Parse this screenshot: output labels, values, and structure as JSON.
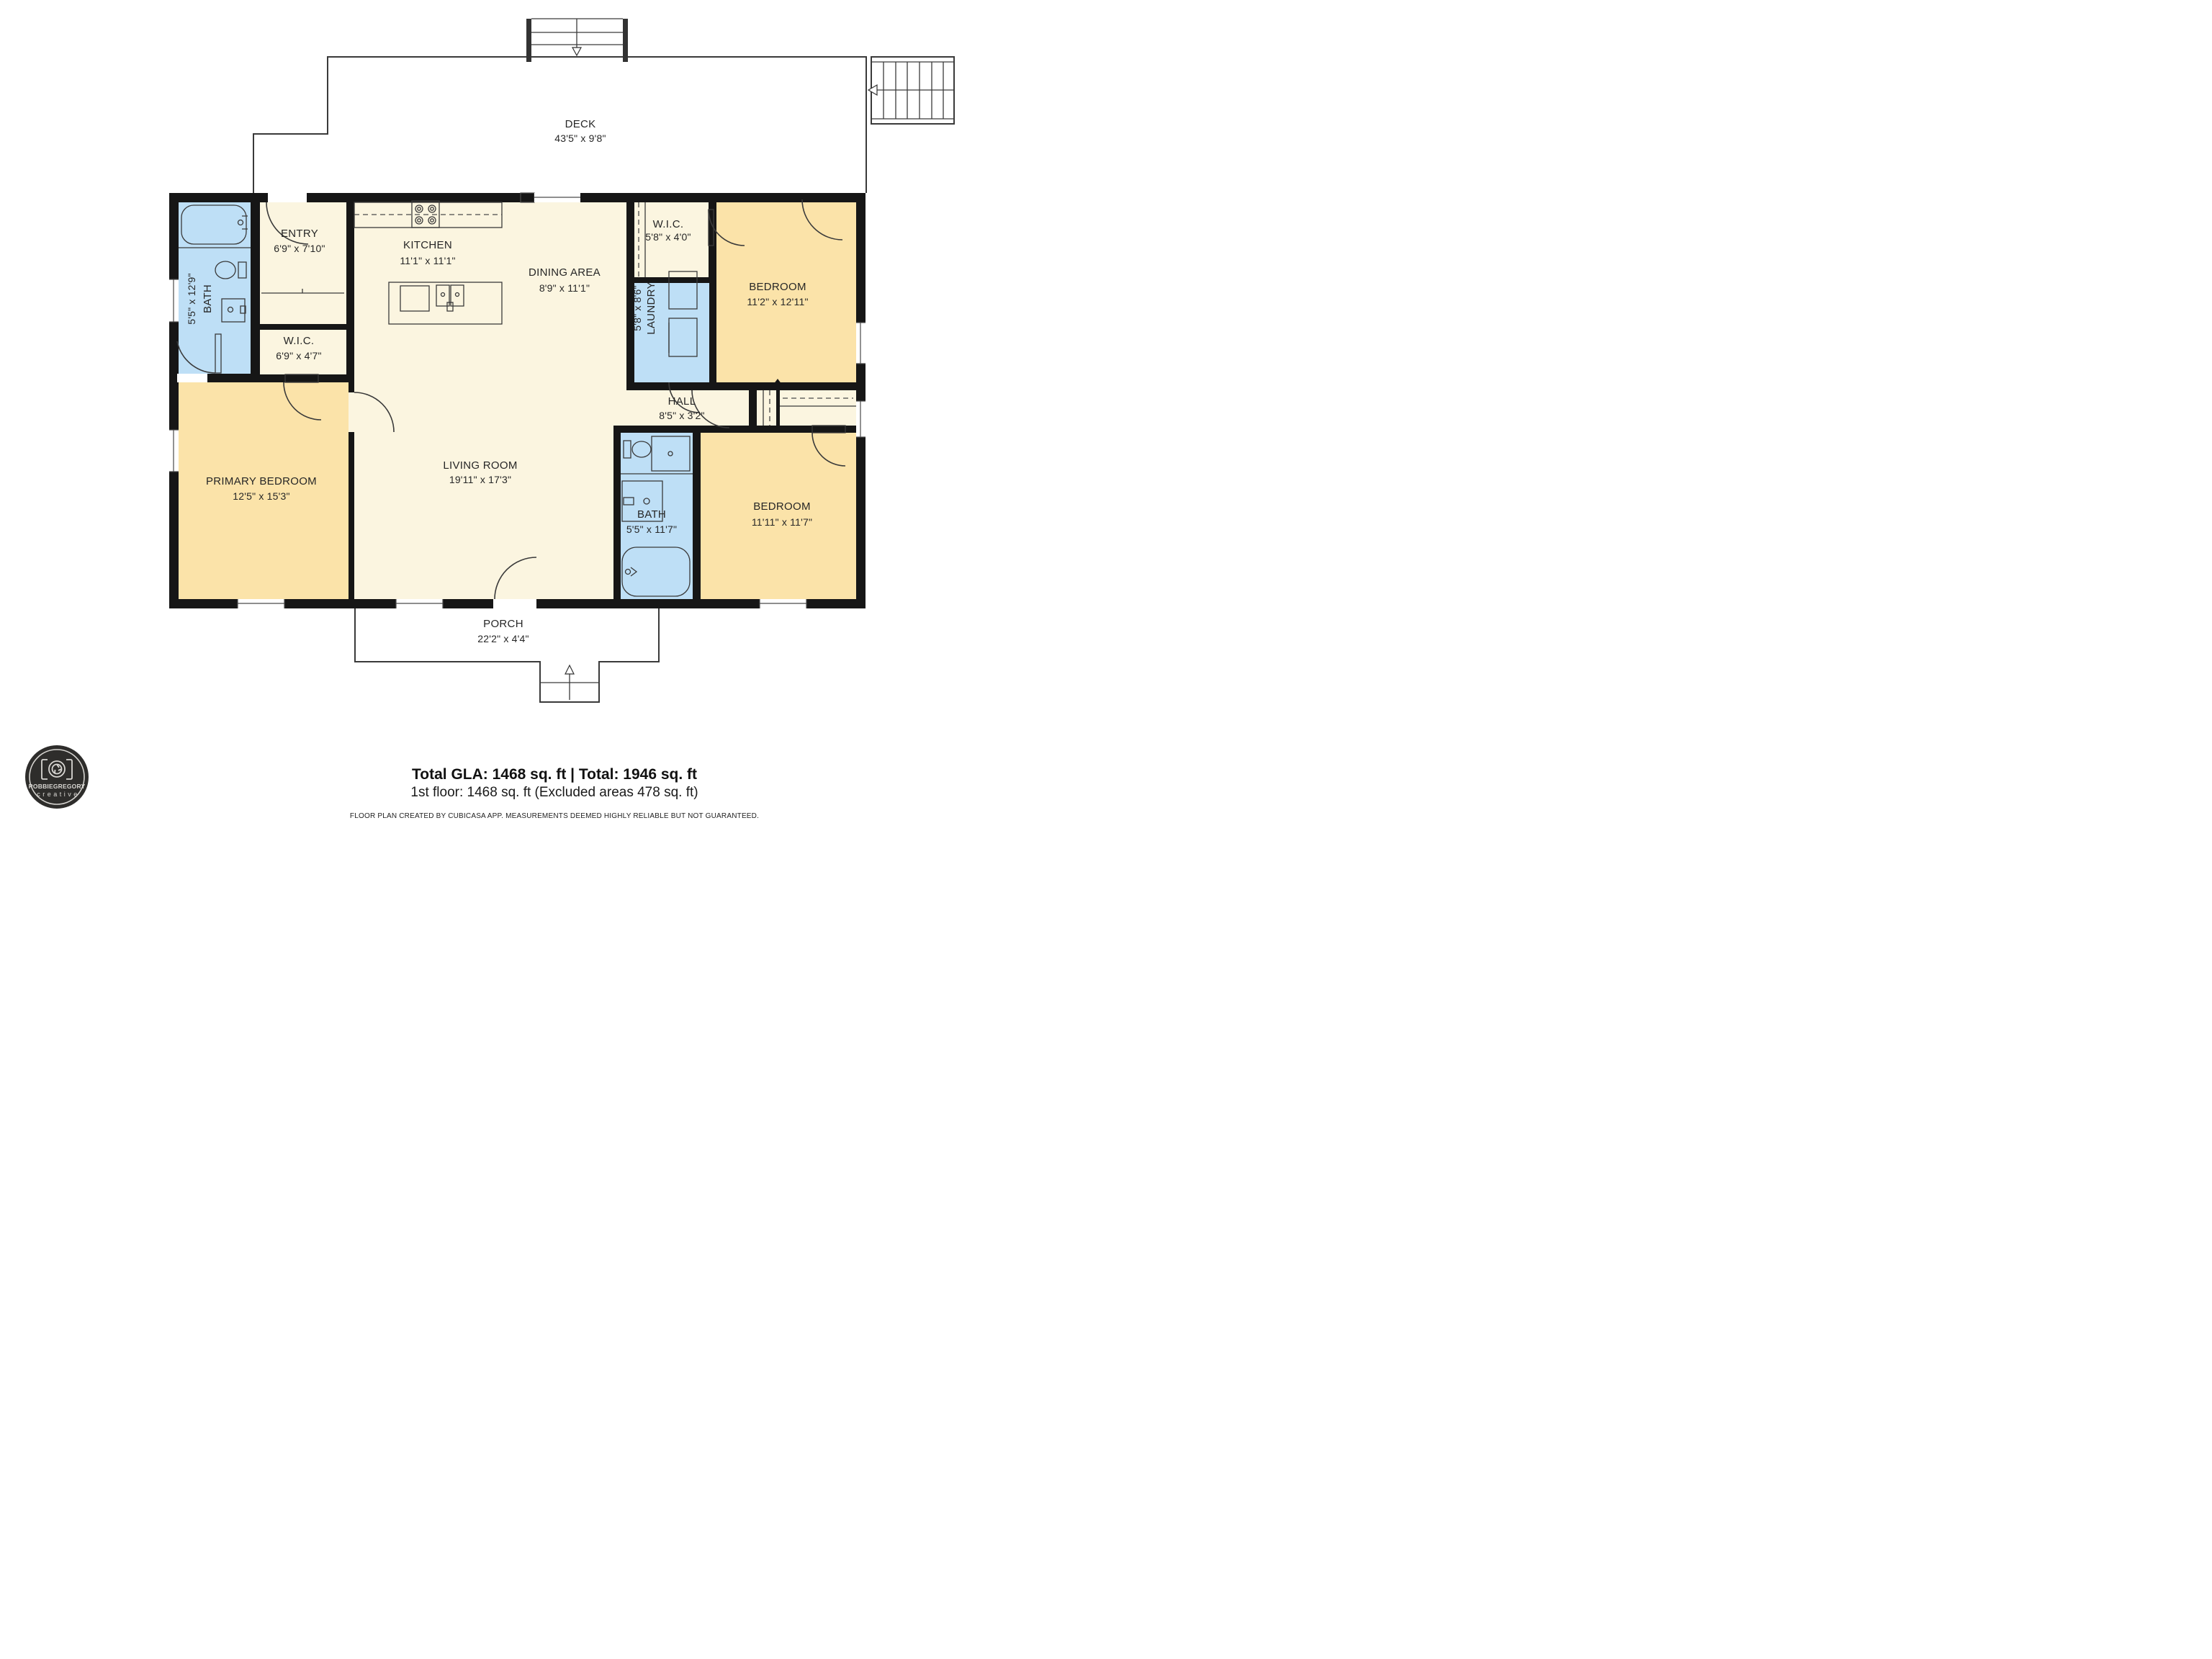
{
  "colors": {
    "wall": "#161616",
    "room_cream": "#FBF5E0",
    "room_yellow": "#FBE3A9",
    "room_blue": "#BEDFF6",
    "logo_bg": "#2e2d2b",
    "logo_fg": "#d8d6d2"
  },
  "deck": {
    "name": "DECK",
    "dims": "43'5\" x 9'8\""
  },
  "rooms": {
    "entry": {
      "name": "ENTRY",
      "dims": "6'9\" x 7'10\""
    },
    "kitchen": {
      "name": "KITCHEN",
      "dims": "11'1\" x 11'1\""
    },
    "dining": {
      "name": "DINING AREA",
      "dims": "8'9\" x 11'1\""
    },
    "wic_top": {
      "name": "W.I.C.",
      "dims": "5'8\" x 4'0\""
    },
    "laundry": {
      "name": "LAUNDRY",
      "dims": "5'8\" x 8'6\""
    },
    "bedroom_top": {
      "name": "BEDROOM",
      "dims": "11'2\" x 12'11\""
    },
    "bath_left": {
      "name": "BATH",
      "dims": "5'5\" x 12'9\""
    },
    "wic_left": {
      "name": "W.I.C.",
      "dims": "6'9\" x 4'7\""
    },
    "primary": {
      "name": "PRIMARY BEDROOM",
      "dims": "12'5\" x 15'3\""
    },
    "living": {
      "name": "LIVING ROOM",
      "dims": "19'11\" x 17'3\""
    },
    "hall": {
      "name": "HALL",
      "dims": "8'5\" x 3'2\""
    },
    "bath_bottom": {
      "name": "BATH",
      "dims": "5'5\" x 11'7\""
    },
    "bedroom_bottom": {
      "name": "BEDROOM",
      "dims": "11'11\" x 11'7\""
    },
    "porch": {
      "name": "PORCH",
      "dims": "22'2\" x 4'4\""
    }
  },
  "footer": {
    "total_line": "Total GLA: 1468 sq. ft | Total: 1946 sq. ft",
    "floor_line": "1st floor: 1468 sq. ft (Excluded areas 478 sq. ft)",
    "disclaimer": "FLOOR PLAN CREATED BY CUBICASA APP. MEASUREMENTS DEEMED HIGHLY RELIABLE BUT NOT GUARANTEED."
  },
  "logo": {
    "brand": "ROBBIEGREGORY",
    "tagline": "creative"
  }
}
